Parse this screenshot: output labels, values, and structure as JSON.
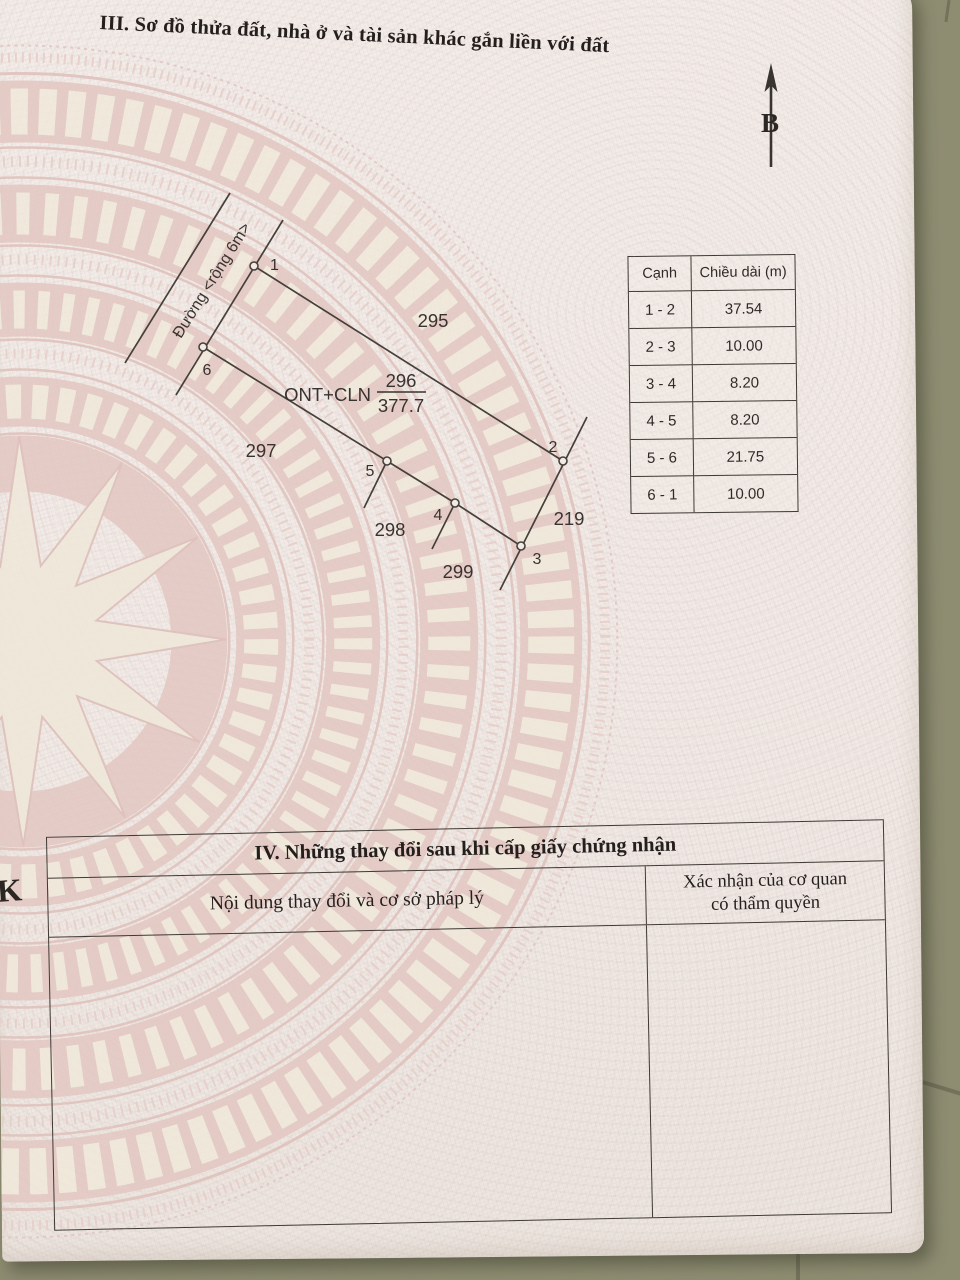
{
  "section3": {
    "title": "III. Sơ đồ thửa đất, nhà ở và tài sản khác gắn liền với đất"
  },
  "compass": {
    "north_label": "B"
  },
  "plot_diagram": {
    "road_label": "Đường <rộng 6m>",
    "parcel_label": "ONT+CLN",
    "parcel_number": "296",
    "parcel_area": "377.7",
    "vertex_labels": [
      "1",
      "2",
      "3",
      "4",
      "5",
      "6"
    ],
    "adjacent_parcels": [
      "295",
      "297",
      "298",
      "299",
      "219"
    ]
  },
  "edge_table": {
    "headers": [
      "Cạnh",
      "Chiều dài (m)"
    ],
    "rows": [
      {
        "edge": "1 - 2",
        "length": "37.54"
      },
      {
        "edge": "2 - 3",
        "length": "10.00"
      },
      {
        "edge": "3 - 4",
        "length": "8.20"
      },
      {
        "edge": "4 - 5",
        "length": "8.20"
      },
      {
        "edge": "5 - 6",
        "length": "21.75"
      },
      {
        "edge": "6 - 1",
        "length": "10.00"
      }
    ]
  },
  "section4": {
    "title": "IV. Những thay đổi sau khi cấp giấy chứng nhận",
    "col1_header": "Nội dung thay đổi và cơ sở pháp lý",
    "col2_header_line1": "Xác nhận của cơ quan",
    "col2_header_line2": "có thẩm quyền"
  },
  "margin_mark": "K",
  "colors": {
    "paper": "#f2ebe6",
    "pattern_pink": "#e3c7c2",
    "pattern_cream": "#f0e9da",
    "background": "#8e8d72",
    "ink": "#39332f"
  }
}
